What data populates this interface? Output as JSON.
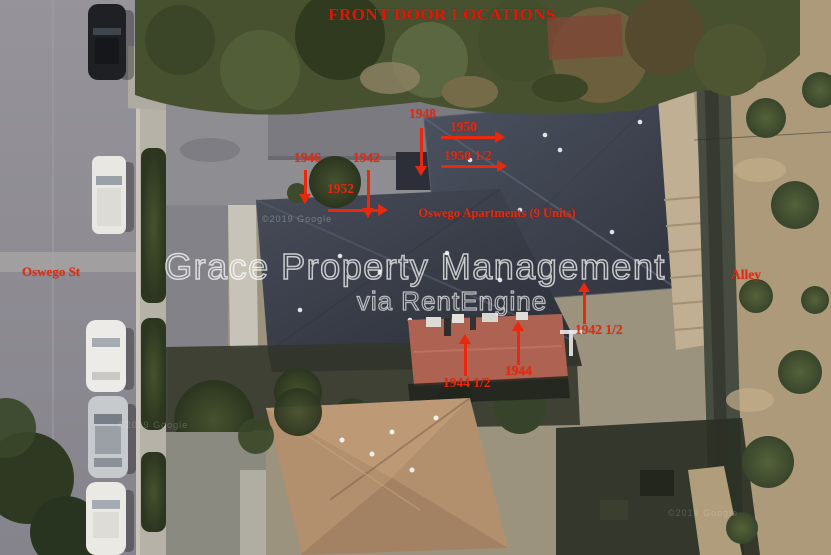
{
  "title": "FRONT DOOR LOCATIONS",
  "watermark": {
    "line1": "Grace Property Management",
    "line2": "via RentEngine"
  },
  "map": {
    "street_label": "Oswego St",
    "alley_label": "Alley",
    "building_label": "Oswego Apartments (9 Units)",
    "attribution": "©2019 Google",
    "imagery": "aerial satellite view of apartment property with street, alley, rooftops, trees and parked cars"
  },
  "annotations": [
    {
      "label": "1948",
      "arrow": "down"
    },
    {
      "label": "1950",
      "arrow": "right"
    },
    {
      "label": "1950 1/2",
      "arrow": "right"
    },
    {
      "label": "1946",
      "arrow": "down"
    },
    {
      "label": "1942",
      "arrow": "down"
    },
    {
      "label": "1952",
      "arrow": "right"
    },
    {
      "label": "1942 1/2",
      "arrow": "up"
    },
    {
      "label": "1944",
      "arrow": "up"
    },
    {
      "label": "1944 1/2",
      "arrow": "up"
    }
  ],
  "colors": {
    "annotation_red": "#e8290e",
    "title_red": "#e51506",
    "roof_slate": "#3c414d",
    "road_gray": "#8d8b91",
    "dirt_tan": "#ad9a7a",
    "watermark": "rgba(255,255,255,0.72)"
  }
}
